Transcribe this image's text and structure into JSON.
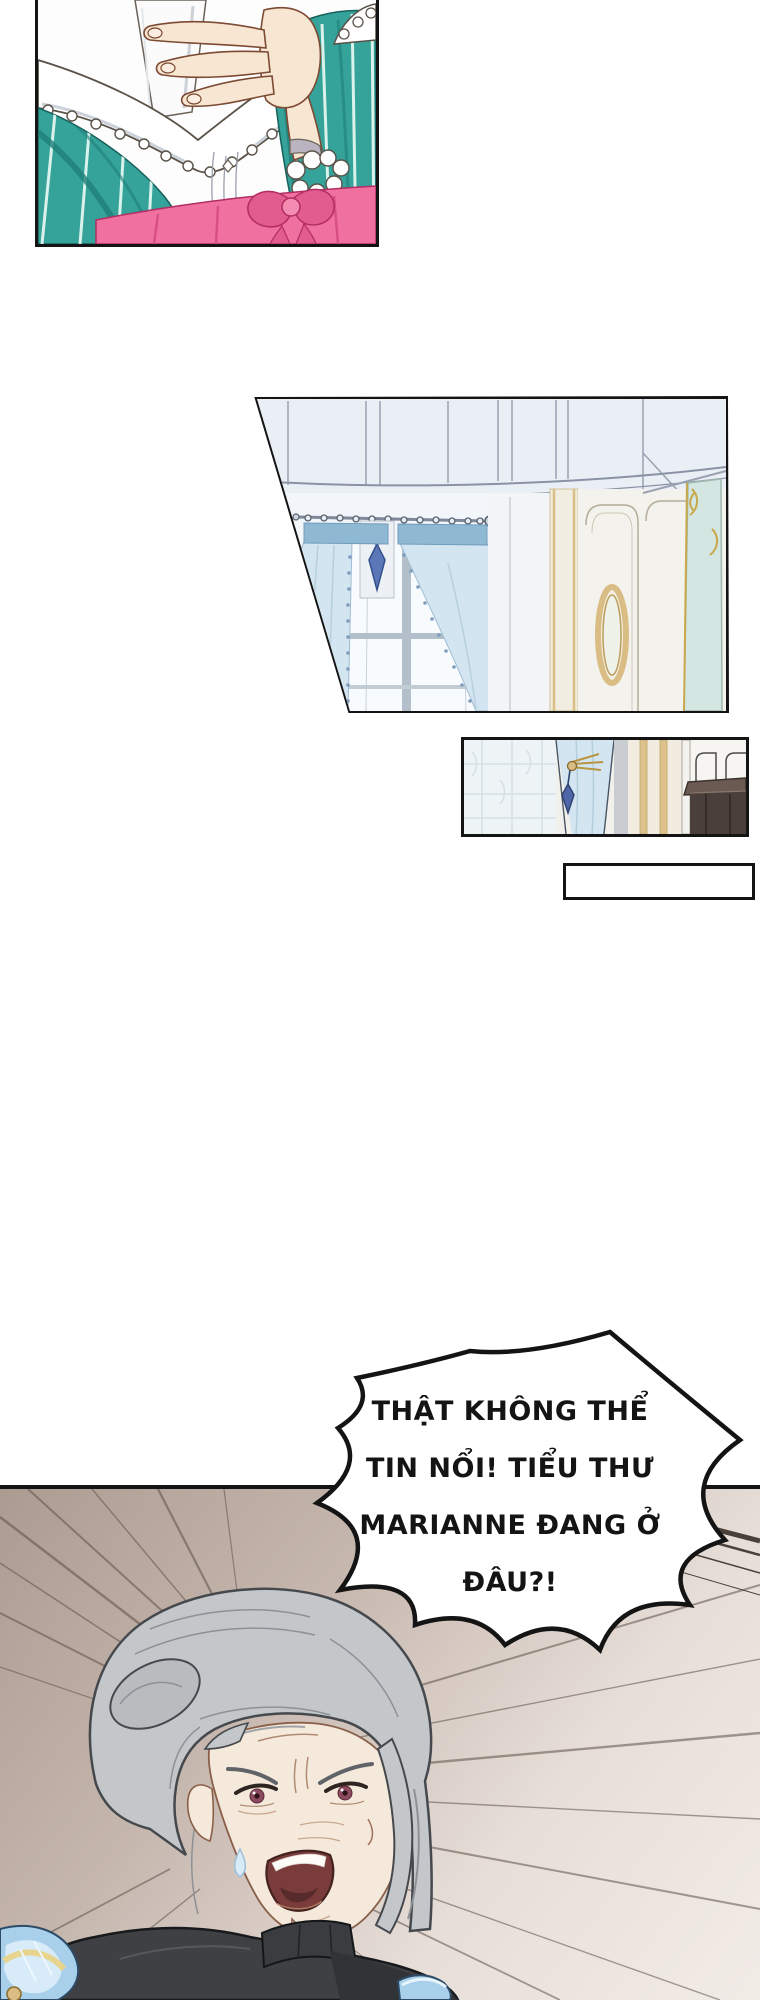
{
  "page": {
    "kind": "webtoon comic page",
    "background": "#ffffff",
    "width_px": 760,
    "height_px": 2000
  },
  "speech_bubble": {
    "style": "jagged shout burst",
    "fill": "#ffffff",
    "outline": "#141414",
    "lines": [
      "THẬT KHÔNG THỂ",
      "TIN NỔI! TIỂU THƯ",
      "MARIANNE ĐANG Ở",
      "ĐÂU?!"
    ],
    "full_text": "THẬT KHÔNG THỂ TIN NỔI! TIỂU THƯ MARIANNE ĐANG Ở ĐÂU?!"
  },
  "caption_box": {
    "text": ""
  },
  "panels": [
    {
      "id": "panel-letter-clutch",
      "description": "Close-up of a hand pressing a white letter to the chest of a teal striped gown with white lace collar and pink sash"
    },
    {
      "id": "panel-room-interior",
      "description": "Slanted panel: palace room with pale blue walls, tied-back light blue curtains over a window, gold oval mirror and teal glass door"
    },
    {
      "id": "panel-curtain-detail",
      "description": "Small panel: curtain with blue tassel tieback, gold striped wallpaper and dark wood furniture"
    },
    {
      "id": "panel-angry-woman",
      "description": "Elderly gray-haired woman in a dark high-collar dress shouting, speed lines radiating behind her"
    }
  ],
  "palette": {
    "panel_border": "#141414",
    "dress_teal": "#35a39a",
    "dress_teal_shadow": "#1f7e78",
    "sash_pink": "#f0719f",
    "lace_white": "#ffffff",
    "skin": "#f6e6d2",
    "curtain_blue": "#d3e5f0",
    "curtain_header_blue": "#8fb9d3",
    "wall_pale_blue": "#eaeff6",
    "wall_cream": "#f4f2ec",
    "gold_trim": "#d9bd85",
    "glass_teal": "#d4e6e1",
    "wood_dark": "#4a3f3a",
    "bg_tan": "#ac9b91",
    "speed_line": "#5d5249",
    "hair_gray": "#c4c7ca",
    "gown_charcoal": "#3e4043",
    "shoulder_blue": "#a9d0ea",
    "eye_red": "#8e4a5e"
  }
}
